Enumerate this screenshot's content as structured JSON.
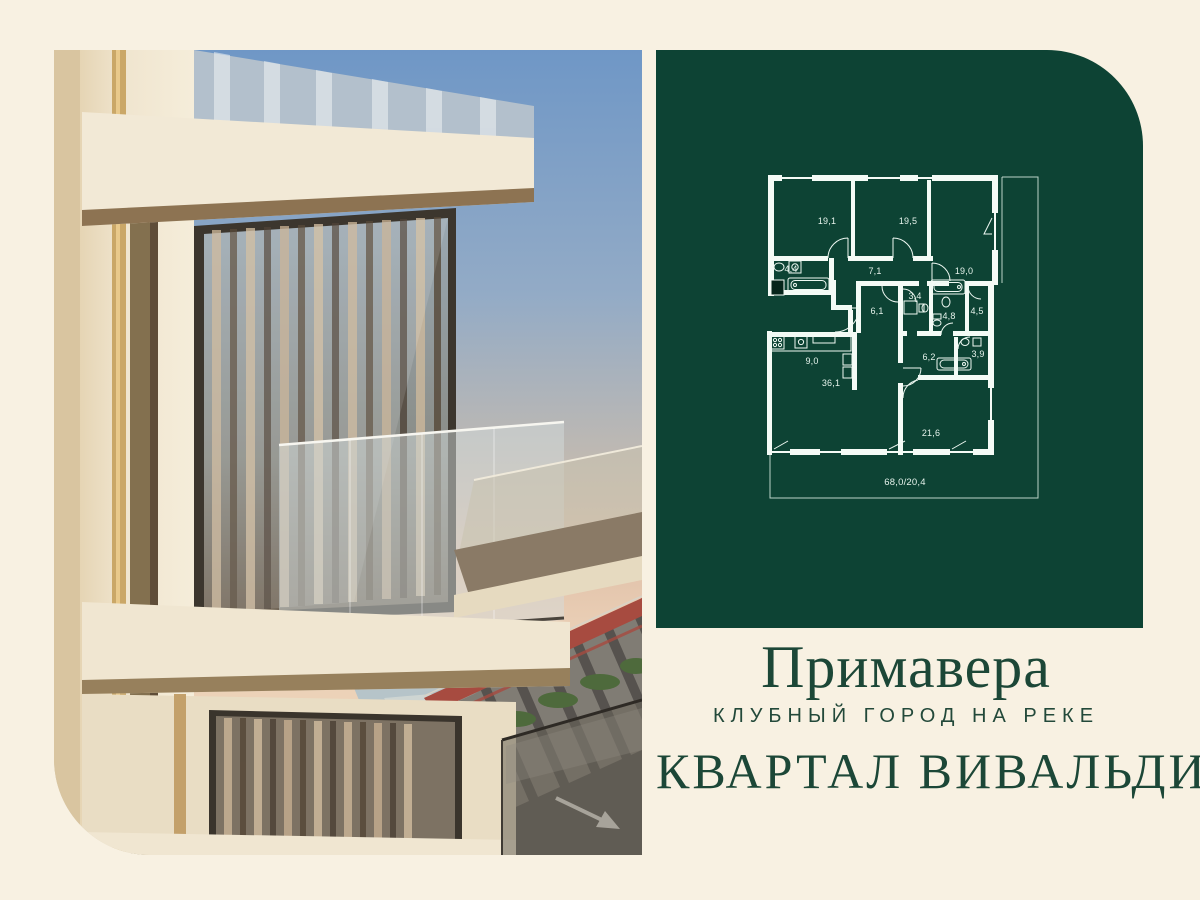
{
  "poster": {
    "background_color": "#f8f1e2",
    "panel_green": "#0d4334",
    "text_green": "#1c4737",
    "plan_line_color": "#f4fbf6"
  },
  "floorplan": {
    "total_area_label": "68,0/20,4",
    "rooms": [
      {
        "name": "bedroom-1",
        "area": "19,1"
      },
      {
        "name": "bedroom-2",
        "area": "19,5"
      },
      {
        "name": "bedroom-3",
        "area": "19,0"
      },
      {
        "name": "bathroom-1",
        "area": "4,4"
      },
      {
        "name": "hallway-1",
        "area": "7,1"
      },
      {
        "name": "wc",
        "area": "3,4"
      },
      {
        "name": "hallway-2",
        "area": "6,1"
      },
      {
        "name": "bathroom-2",
        "area": "4,8"
      },
      {
        "name": "wardrobe",
        "area": "4,5"
      },
      {
        "name": "kitchen",
        "area": "9,0"
      },
      {
        "name": "living-room",
        "area": "36,1"
      },
      {
        "name": "hallway-3",
        "area": "6,2"
      },
      {
        "name": "bathroom-3",
        "area": "3,9"
      },
      {
        "name": "bedroom-4",
        "area": "21,6"
      }
    ]
  },
  "branding": {
    "project_title": "Примавера",
    "project_subtitle": "КЛУБНЫЙ ГОРОД НА РЕКЕ",
    "quarter_title": "КВАРТАЛ ВИВАЛЬДИ"
  }
}
